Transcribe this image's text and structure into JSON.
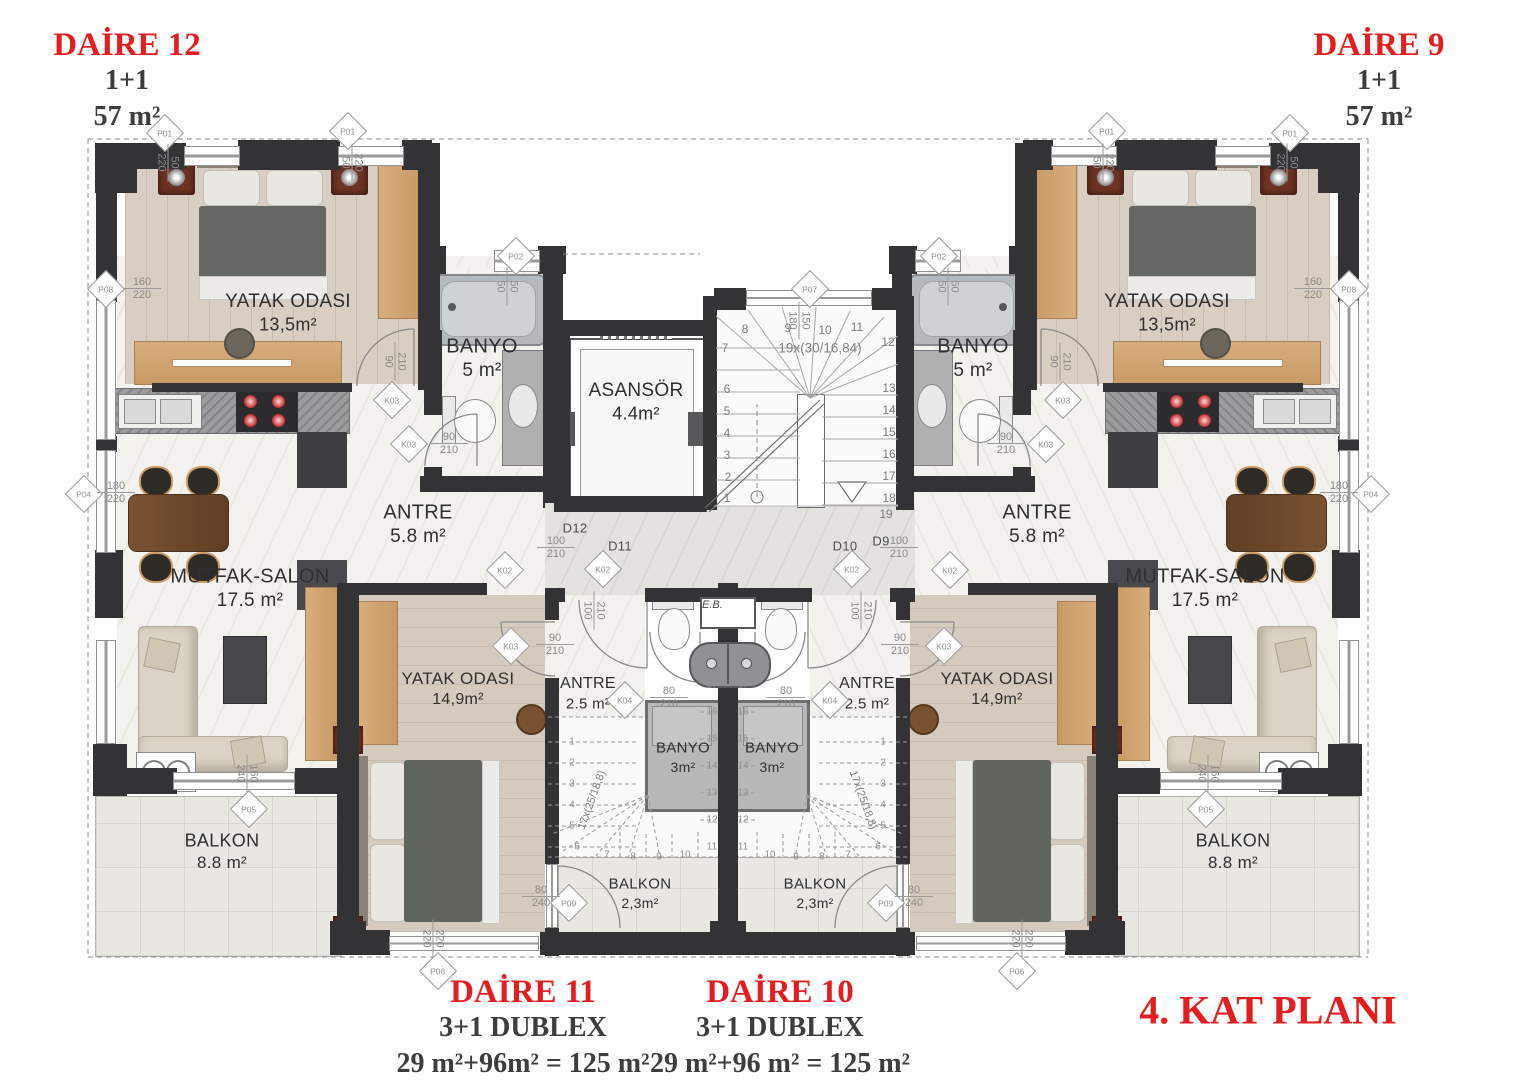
{
  "plan_title": "4. KAT PLANI",
  "apartments": {
    "daire12": {
      "name": "DAİRE 12",
      "type": "1+1",
      "area": "57 m²"
    },
    "daire9": {
      "name": "DAİRE 9",
      "type": "1+1",
      "area": "57 m²"
    },
    "daire11": {
      "name": "DAİRE 11",
      "type": "3+1 DUBLEX",
      "area": "29 m²+96m² = 125 m²"
    },
    "daire10": {
      "name": "DAİRE 10",
      "type": "3+1 DUBLEX",
      "area": "29 m²+96 m² = 125 m²"
    }
  },
  "rooms": {
    "yatak_upper": {
      "name": "YATAK ODASI",
      "area": "13,5m²"
    },
    "banyo_upper": {
      "name": "BANYO",
      "area": "5 m²"
    },
    "asansor": {
      "name": "ASANSÖR",
      "area": "4.4m²"
    },
    "antre_upper": {
      "name": "ANTRE",
      "area": "5.8 m²"
    },
    "mutfak": {
      "name": "MUTFAK-SALON",
      "area": "17.5 m²"
    },
    "yatak_duplex": {
      "name": "YATAK ODASI",
      "area": "14,9m²"
    },
    "antre_duplex": {
      "name": "ANTRE",
      "area": "2.5 m²"
    },
    "banyo_duplex": {
      "name": "BANYO",
      "area": "3m²"
    },
    "balkon_small": {
      "name": "BALKON",
      "area": "2,3m²"
    },
    "balkon_big": {
      "name": "BALKON",
      "area": "8.8 m²"
    }
  },
  "stairs": {
    "main_note": "19x(30/16,84)",
    "main_steps": [
      "1",
      "2",
      "3",
      "4",
      "5",
      "6",
      "7",
      "8",
      "9",
      "10",
      "11",
      "12",
      "13",
      "14",
      "15",
      "16",
      "17",
      "18",
      "19"
    ],
    "duplex_note": "17x(25/18,8)",
    "duplex_steps": [
      "1",
      "2",
      "3",
      "4",
      "5",
      "6",
      "7",
      "8",
      "9",
      "10",
      "11",
      "12",
      "13",
      "14",
      "15",
      "16",
      "17"
    ]
  },
  "tags": {
    "p01": "P01",
    "p02": "P02",
    "p04": "P04",
    "p05": "P05",
    "p06": "P06",
    "p07": "P07",
    "p08": "P08",
    "p09": "P09",
    "k02": "K02",
    "k03": "K03",
    "k04": "K04",
    "d9": "D9",
    "d10": "D10",
    "d11": "D11",
    "d12": "D12",
    "eb": "E.B."
  },
  "dims": {
    "w90_210": [
      "90",
      "210"
    ],
    "w100_210": [
      "100",
      "210"
    ],
    "w210_90": [
      "210",
      "90"
    ],
    "w210_100": [
      "210",
      "100"
    ],
    "w80_210": [
      "80",
      "210"
    ],
    "w50_50": [
      "50",
      "50"
    ],
    "w160_220": [
      "160",
      "220"
    ],
    "w180_220": [
      "180",
      "220"
    ],
    "w160_240": [
      "160",
      "240"
    ],
    "w220_220": [
      "220",
      "220"
    ],
    "w80_240": [
      "80",
      "240"
    ],
    "w150_180": [
      "150",
      "180"
    ],
    "w50_220": [
      "50",
      "220"
    ],
    "w220_50": [
      "220",
      "50"
    ]
  },
  "colors": {
    "accent_red": "#e41e20",
    "wall": "#333336",
    "label": "#2f2f31"
  }
}
